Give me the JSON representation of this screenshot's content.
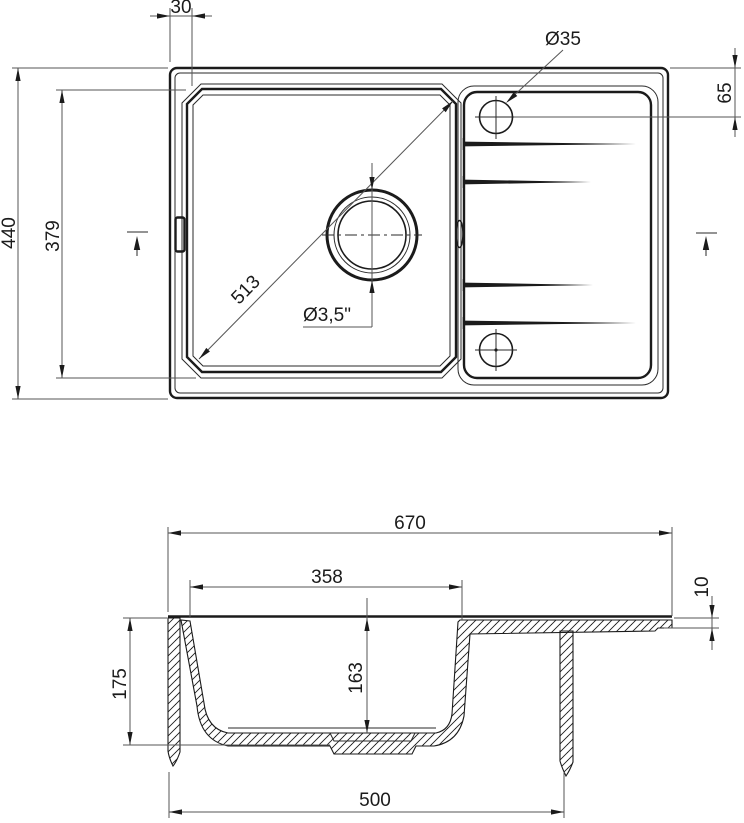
{
  "colors": {
    "background": "#ffffff",
    "line": "#1b1b1b",
    "dimension_line": "#555555"
  },
  "plan_view": {
    "edge_to_bowl_offset": "30",
    "overall_depth": "440",
    "bowl_flange_depth": "379",
    "bowl_diagonal": "513",
    "faucet_hole_diameter": "Ø35",
    "faucet_hole_center_from_edge": "65",
    "drain_hole_diameter": "Ø3,5\""
  },
  "section_view": {
    "overall_length": "670",
    "bowl_inner_length": "358",
    "edge_thickness": "10",
    "total_height": "175",
    "bowl_inner_depth": "163",
    "underside_length": "500"
  }
}
